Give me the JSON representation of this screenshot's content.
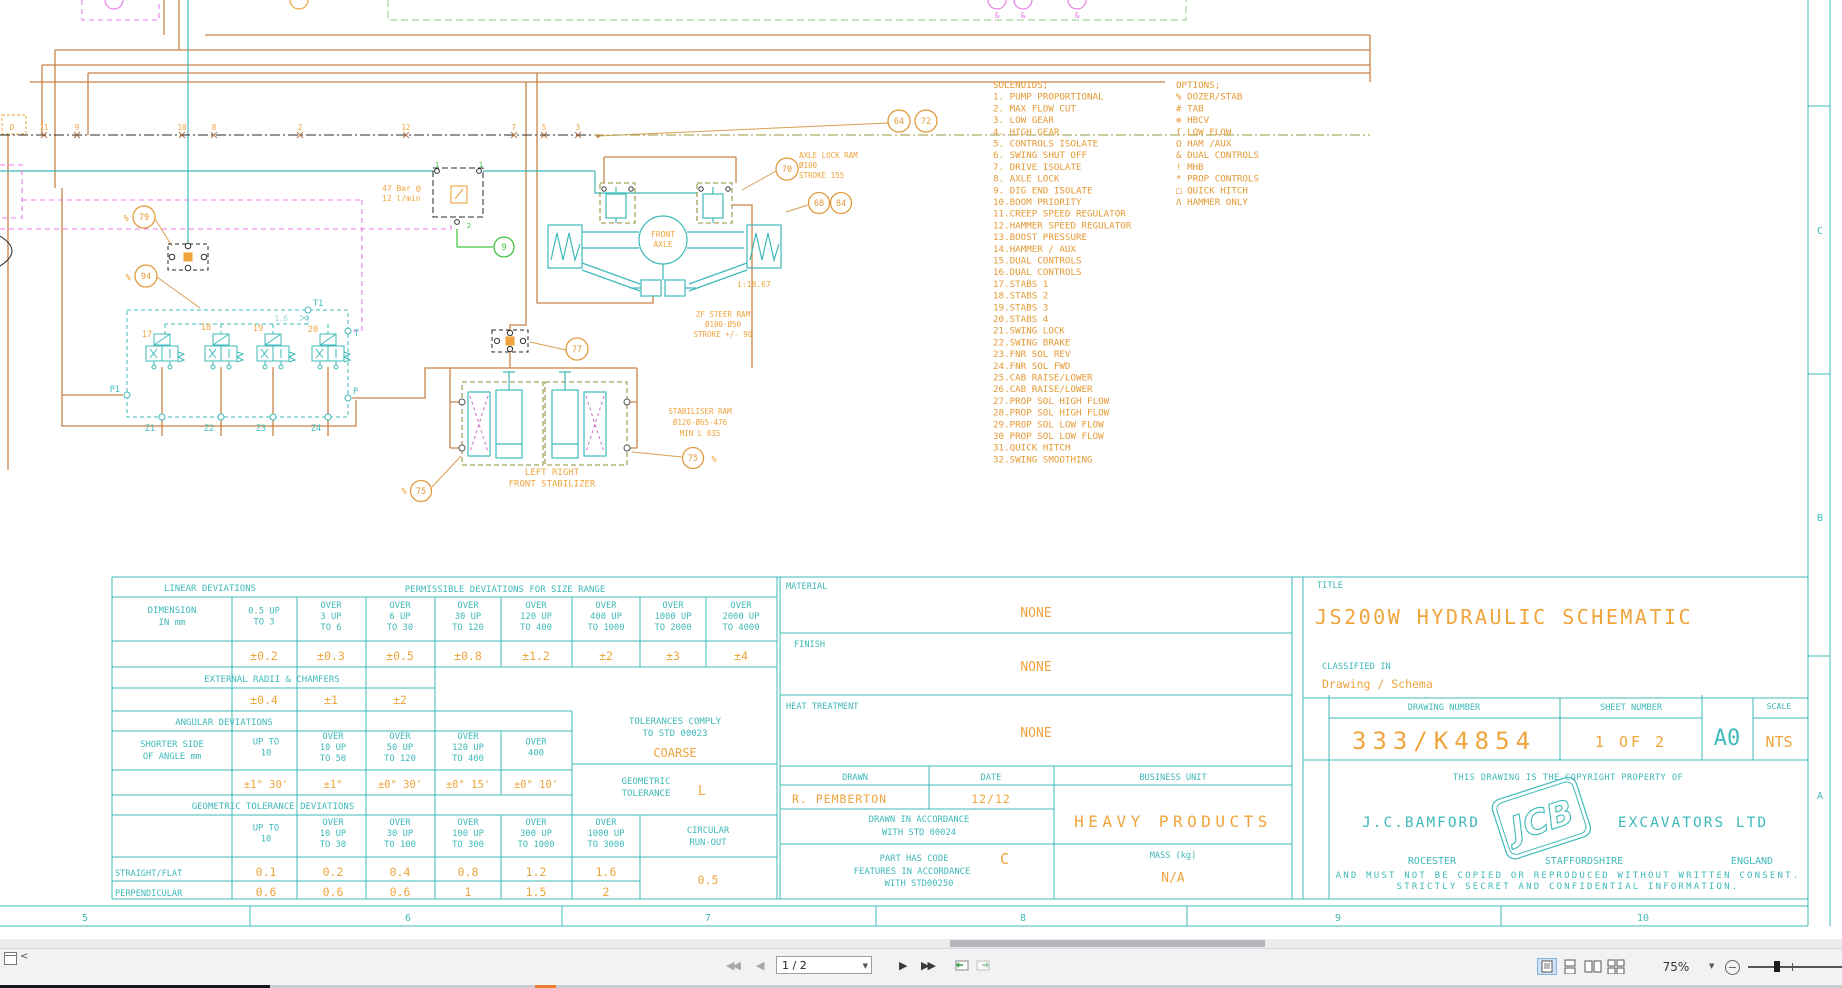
{
  "viewer": {
    "page_display": "1 / 2",
    "zoom_level": "75%"
  },
  "zones": {
    "bottom": [
      "5",
      "6",
      "7",
      "8",
      "9",
      "10"
    ],
    "right": [
      "C",
      "B",
      "A"
    ]
  },
  "solenoids": {
    "header": "SOLENOIDS;",
    "items": [
      "1. PUMP PROPORTIONAL",
      "2. MAX FLOW CUT",
      "3. LOW GEAR",
      "4. HIGH GEAR",
      "5. CONTROLS ISOLATE",
      "6. SWING SHUT OFF",
      "7. DRIVE ISOLATE",
      "8. AXLE LOCK",
      "9. DIG END ISOLATE",
      "10.BOOM PRIORITY",
      "11.CREEP SPEED REGULATOR",
      "12.HAMMER SPEED REGULATOR",
      "13.BOOST PRESSURE",
      "14.HAMMER / AUX",
      "15.DUAL CONTROLS",
      "16.DUAL CONTROLS",
      "17.STABS 1",
      "18.STABS 2",
      "19.STABS 3",
      "20.STABS 4",
      "21.SWING LOCK",
      "22.SWING BRAKE",
      "23.FNR SOL REV",
      "24.FNR SOL FWD",
      "25.CAB RAISE/LOWER",
      "26.CAB RAISE/LOWER",
      "27.PROP SOL HIGH FLOW",
      "28.PROP SOL HIGH FLOW",
      "29.PROP SOL LOW FLOW",
      "30 PROP SOL LOW FLOW",
      "31.QUICK HITCH",
      "32.SWING SMOOTHING"
    ]
  },
  "options": {
    "header": "OPTIONS;",
    "items": [
      "% DOZER/STAB",
      "# TAB",
      "⊗ HBCV",
      "ſ LOW FLOW",
      "Ω HAM /AUX",
      "& DUAL CONTROLS",
      "! MHB",
      "* PROP CONTROLS",
      "□ QUICK HITCH",
      "Λ HAMMER ONLY"
    ]
  },
  "schematic": {
    "pressure": [
      "47 Bar @",
      "12 l/min"
    ],
    "axle_lock_ram": [
      "AXLE LOCK RAM",
      "Ø100",
      "STROKE 155"
    ],
    "front_axle": [
      "FRONT",
      "AXLE"
    ],
    "ratio": "i:18.67",
    "steer_ram": [
      "ZF STEER RAM",
      "Ø100-Ø50",
      "STROKE +/- 90"
    ],
    "stabiliser_ram": [
      "STABILISER RAM",
      "Ø120-Ø65-476",
      "MIN L  835"
    ],
    "stabilizer_caption": [
      "LEFT   RIGHT",
      "FRONT STABILIZER"
    ],
    "bus_nodes": [
      "D",
      "11",
      "9",
      "10",
      "8",
      "2",
      "12",
      "7",
      "5",
      "3"
    ],
    "valve_ids": [
      "17",
      "18",
      "19",
      "20"
    ],
    "z_ports": [
      "Z1",
      "Z2",
      "Z3",
      "Z4"
    ],
    "ports": {
      "p1": "P1",
      "p": "P",
      "t": "T",
      "t1": "T1"
    },
    "orifice": "1.6",
    "valve_port_1": "1",
    "valve_port_2": "2",
    "percent": "%",
    "ampersand": "&",
    "callouts": {
      "c64": "64",
      "c72": "72",
      "c70": "70",
      "c68": "68",
      "c84": "84",
      "c79": "79",
      "c94": "94",
      "c77": "77",
      "c75": "75",
      "c9": "9"
    }
  },
  "tolerances": {
    "linear_header": "LINEAR DEVIATIONS",
    "permissible_header": "PERMISSIBLE DEVIATIONS FOR SIZE RANGE",
    "dimension_label": [
      "DIMENSION",
      "IN mm"
    ],
    "linear_ranges": [
      [
        "0.5 UP",
        "TO 3"
      ],
      [
        "OVER",
        "3 UP",
        "TO 6"
      ],
      [
        "OVER",
        "6 UP",
        "TO 30"
      ],
      [
        "OVER",
        "30 UP",
        "TO 120"
      ],
      [
        "OVER",
        "120 UP",
        "TO 400"
      ],
      [
        "OVER",
        "400 UP",
        "TO 1000"
      ],
      [
        "OVER",
        "1000 UP",
        "TO 2000"
      ],
      [
        "OVER",
        "2000 UP",
        "TO 4000"
      ]
    ],
    "linear_values": [
      "±0.2",
      "±0.3",
      "±0.5",
      "±0.8",
      "±1.2",
      "±2",
      "±3",
      "±4"
    ],
    "external_header": "EXTERNAL RADII & CHAMFERS",
    "external_values": [
      "±0.4",
      "±1",
      "±2"
    ],
    "angular_header": "ANGULAR DEVIATIONS",
    "shorter_label": [
      "SHORTER SIDE",
      "OF ANGLE mm"
    ],
    "angular_ranges": [
      [
        "UP TO",
        "10"
      ],
      [
        "OVER",
        "10 UP",
        "TO 50"
      ],
      [
        "OVER",
        "50 UP",
        "TO 120"
      ],
      [
        "OVER",
        "120 UP",
        "TO 400"
      ],
      [
        "OVER",
        "400"
      ]
    ],
    "angular_values": [
      "±1° 30'",
      "±1°",
      "±0° 30'",
      "±0° 15'",
      "±0° 10'"
    ],
    "comply1": "TOLERANCES COMPLY",
    "comply2": "TO STD 00023",
    "coarse": "COARSE",
    "geo_tol1": "GEOMETRIC",
    "geo_tol2": "TOLERANCE",
    "geo_tol_value": "L",
    "geo_header": "GEOMETRIC TOLERANCE DEVIATIONS",
    "geo_ranges": [
      [
        "UP TO",
        "10"
      ],
      [
        "OVER",
        "10 UP",
        "TO 30"
      ],
      [
        "OVER",
        "30 UP",
        "TO 100"
      ],
      [
        "OVER",
        "100 UP",
        "TO 300"
      ],
      [
        "OVER",
        "300 UP",
        "TO 1000"
      ],
      [
        "OVER",
        "1000 UP",
        "TO 3000"
      ]
    ],
    "straight_label": "STRAIGHT/FLAT",
    "straight_values": [
      "0.1",
      "0.2",
      "0.4",
      "0.8",
      "1.2",
      "1.6"
    ],
    "perp_label": "PERPENDICULAR",
    "perp_values": [
      "0.6",
      "0.6",
      "0.6",
      "1",
      "1.5",
      "2"
    ],
    "runout_label": [
      "CIRCULAR",
      "RUN-OUT"
    ],
    "runout_value": "0.5"
  },
  "drawing": {
    "material_label": "MATERIAL",
    "material_value": "NONE",
    "finish_label": "FINISH",
    "finish_value": "NONE",
    "heat_label": "HEAT TREATMENT",
    "heat_value": "NONE",
    "title_label": "TITLE",
    "title": "JS200W HYDRAULIC SCHEMATIC",
    "classified_label": "CLASSIFIED IN",
    "classified_value": "Drawing / Schema",
    "drawing_number_label": "DRAWING NUMBER",
    "drawing_number": "333/K4854",
    "sheet_number_label": "SHEET NUMBER",
    "sheet_number": "1 OF 2",
    "size": "A0",
    "scale_label": "SCALE",
    "scale": "NTS",
    "drawn_label": "DRAWN",
    "drawn": "R. PEMBERTON",
    "date_label": "DATE",
    "date": "12/12",
    "business_unit_label": "BUSINESS UNIT",
    "business_unit": "HEAVY PRODUCTS",
    "std24_line1": "DRAWN IN ACCORDANCE",
    "std24_line2": "WITH STD 00024",
    "code_line1": "PART HAS CODE",
    "code_value": "C",
    "code_line2": "FEATURES IN ACCORDANCE",
    "code_line3": "WITH STD00250",
    "mass_label": "MASS (kg)",
    "mass_value": "N/A",
    "copyright": "THIS DRAWING IS THE COPYRIGHT PROPERTY OF",
    "company_left": "J.C.BAMFORD",
    "logo": "JCB",
    "company_right": "EXCAVATORS LTD",
    "address1": "ROCESTER",
    "address2": "STAFFORDSHIRE",
    "address3": "ENGLAND",
    "legal1": "AND MUST NOT BE COPIED OR REPRODUCED WITHOUT WRITTEN CONSENT.",
    "legal2": "STRICTLY SECRET AND CONFIDENTIAL INFORMATION.",
    "colors": {
      "cyan": "#3fb9b9",
      "orange": "#efa43c",
      "wire": "#c98248",
      "magenta": "#e97ee9",
      "green": "#3dc43d",
      "olive": "#8f8f3a"
    }
  }
}
